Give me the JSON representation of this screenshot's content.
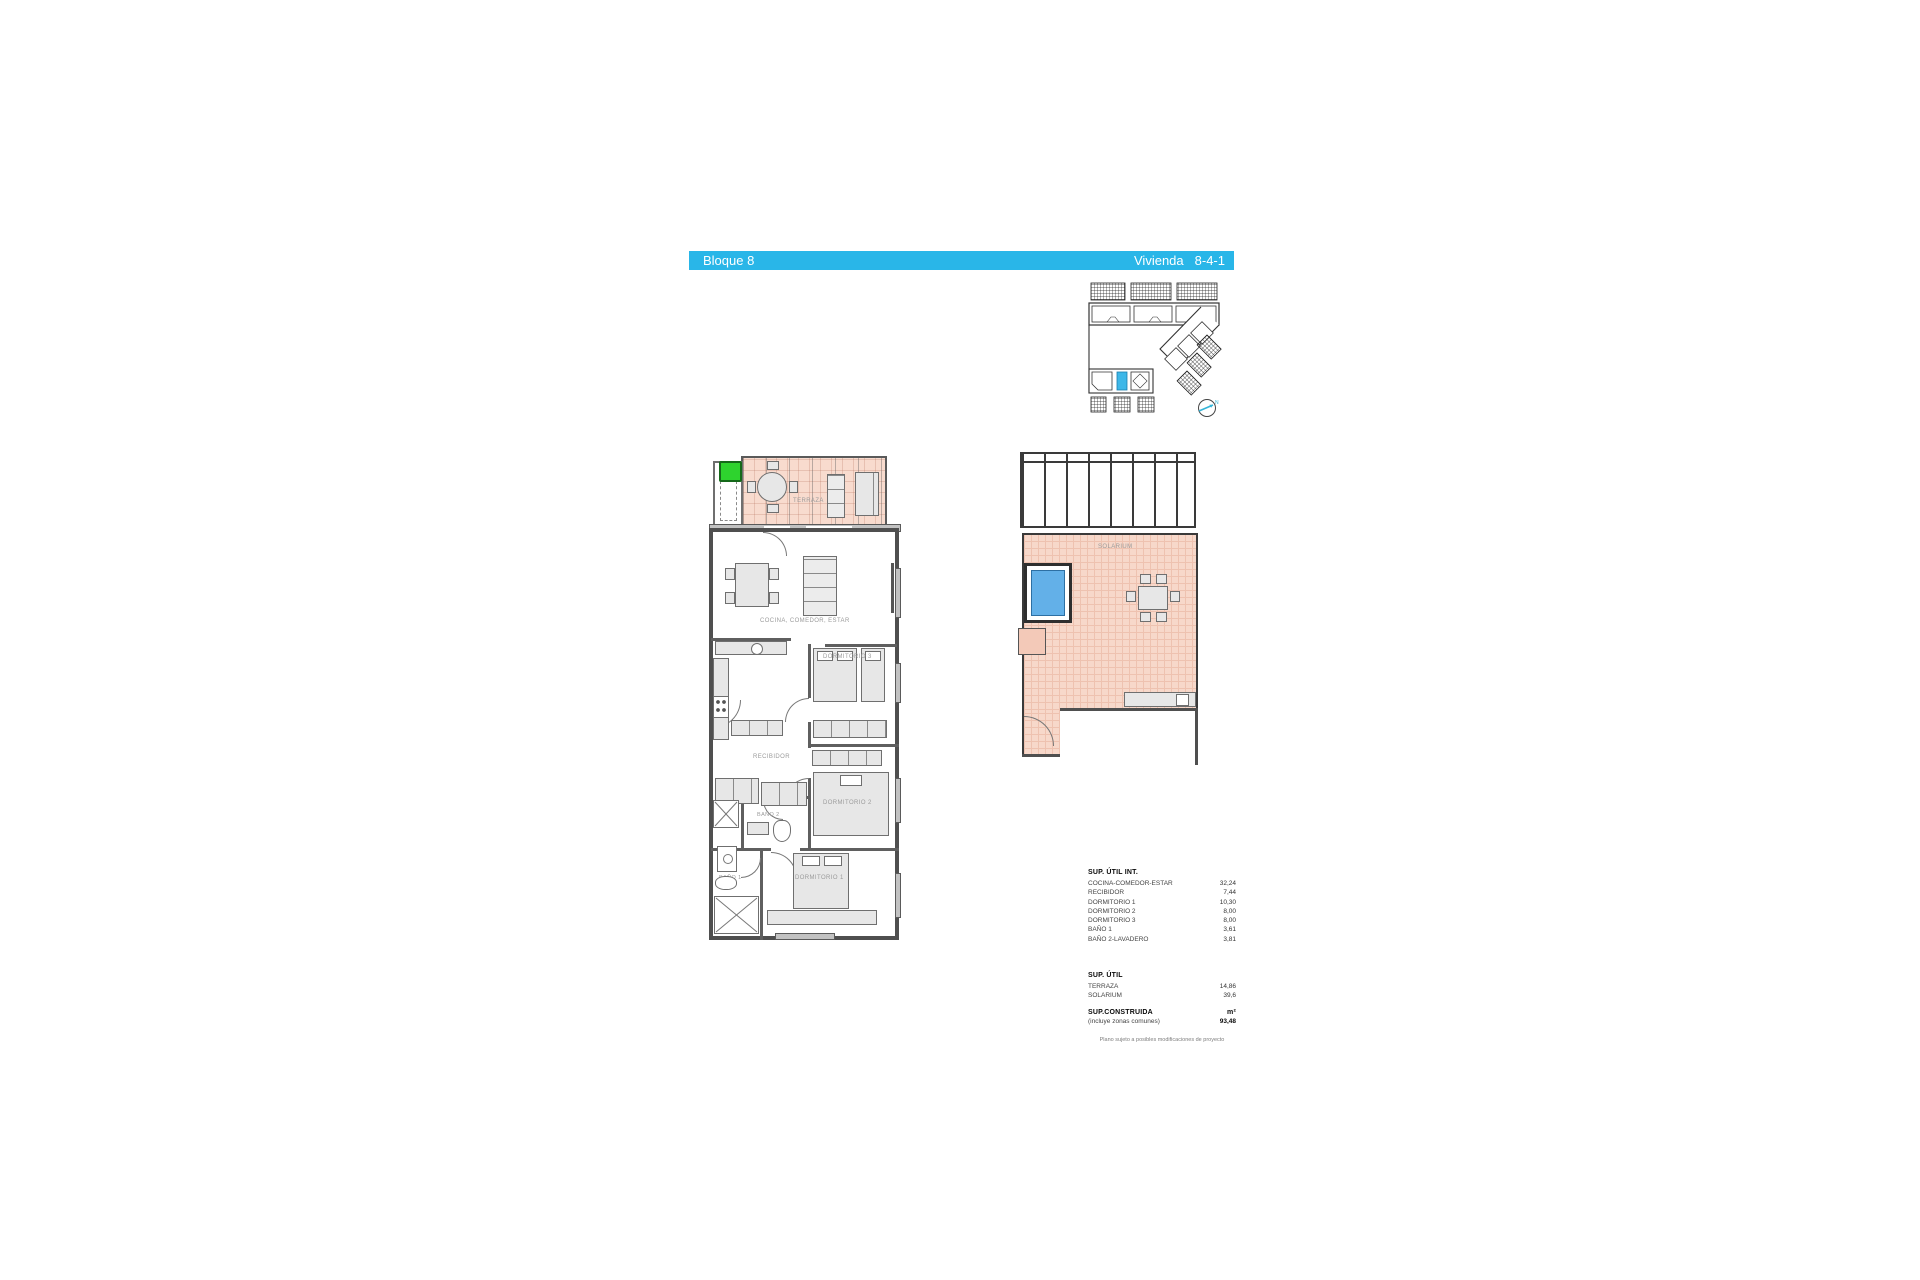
{
  "header": {
    "block_label": "Bloque 8",
    "unit_word": "Vivienda",
    "unit_number": "8-4-1"
  },
  "site_plan": {
    "north_label": "N"
  },
  "apartment_plan": {
    "terraza": "TERRAZA",
    "cocina": "COCINA, COMEDOR, ESTAR",
    "recibidor": "RECIBIDOR",
    "dormitorio1": "DORMITORIO 1",
    "dormitorio2": "DORMITORIO 2",
    "dormitorio3": "DORMITORIO 3",
    "bano1": "BAÑO 1",
    "bano2": "BAÑO 2"
  },
  "solarium_plan": {
    "solarium": "SOLARIUM"
  },
  "area_table": {
    "interior_title": "SUP. ÚTIL INT.",
    "interior_rows": [
      {
        "label": "COCINA-COMEDOR-ESTAR",
        "value": "32,24"
      },
      {
        "label": "RECIBIDOR",
        "value": "7,44"
      },
      {
        "label": "DORMITORIO 1",
        "value": "10,30"
      },
      {
        "label": "DORMITORIO 2",
        "value": "8,00"
      },
      {
        "label": "DORMITORIO 3",
        "value": "8,00"
      },
      {
        "label": "BAÑO 1",
        "value": "3,61"
      },
      {
        "label": "BAÑO 2-LAVADERO",
        "value": "3,81"
      }
    ],
    "exterior_title": "SUP. ÚTIL",
    "exterior_rows": [
      {
        "label": "TERRAZA",
        "value": "14,86"
      },
      {
        "label": "SOLARIUM",
        "value": "39,6"
      }
    ],
    "built_title": "SUP.CONSTRUIDA",
    "built_unit": "m²",
    "built_note": "(incluye zonas comunes)",
    "built_value": "93,48",
    "disclaimer": "Plano sujeto a posibles modificaciones de proyecto"
  },
  "colors": {
    "accent_cyan": "#29b6e8",
    "terrace_fill": "#f8dbce",
    "pool_blue": "#63b0e8",
    "highlight_green": "#2ed32e",
    "unit_highlight_blue": "#3db7e8"
  }
}
